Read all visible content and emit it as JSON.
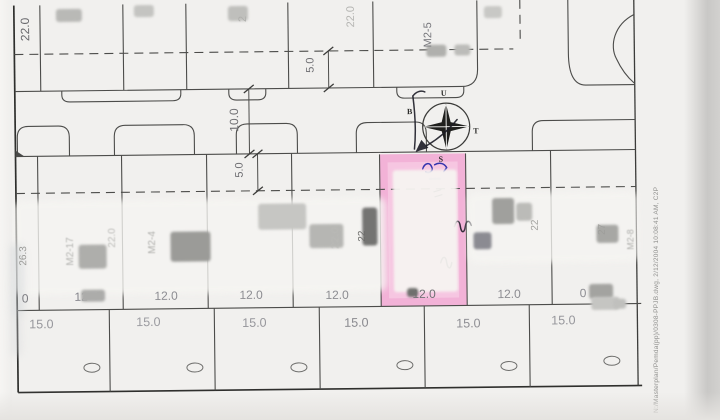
{
  "plan": {
    "dimensions": {
      "top_left_depth": "22.0",
      "top_depth_faint": "22.0",
      "front_setback_top": "5.0",
      "road_width": "10.0",
      "front_setback_mid": "5.0"
    },
    "block_codes": {
      "top": "M2-5",
      "partial_top": "2",
      "mid_1": "M2-17",
      "mid_2": "M2-4",
      "right_edge": "M2-8"
    },
    "depth_labels": {
      "mid_faint": "22.0",
      "mid_left": "22.0",
      "mid_dark": "22",
      "left_edge": "26.3",
      "right_a": "22",
      "right_b": "27"
    },
    "lot_widths_mid": [
      "0",
      "12",
      "12.0",
      "12.0",
      "12.0",
      "12.0",
      "12.0",
      "0"
    ],
    "lot_widths_bottom": [
      "15.0",
      "15.0",
      "15.0",
      "15.0",
      "15.0",
      "15.0"
    ],
    "compass": {
      "north": "U",
      "east": "T",
      "south": "S",
      "west": "B"
    },
    "highlighted_lot": {
      "width_label": "12.0",
      "fill_color": "#f2b2d7",
      "handwritten_marks": [
        "blue-scribble",
        "w-squiggle",
        "w-squiggle"
      ]
    },
    "plot_stamp": "N:/Masterplan/Pemda(pp)/0308-PPJB.dwg, 2/12/2004 10:08:41 AM, C2P"
  }
}
